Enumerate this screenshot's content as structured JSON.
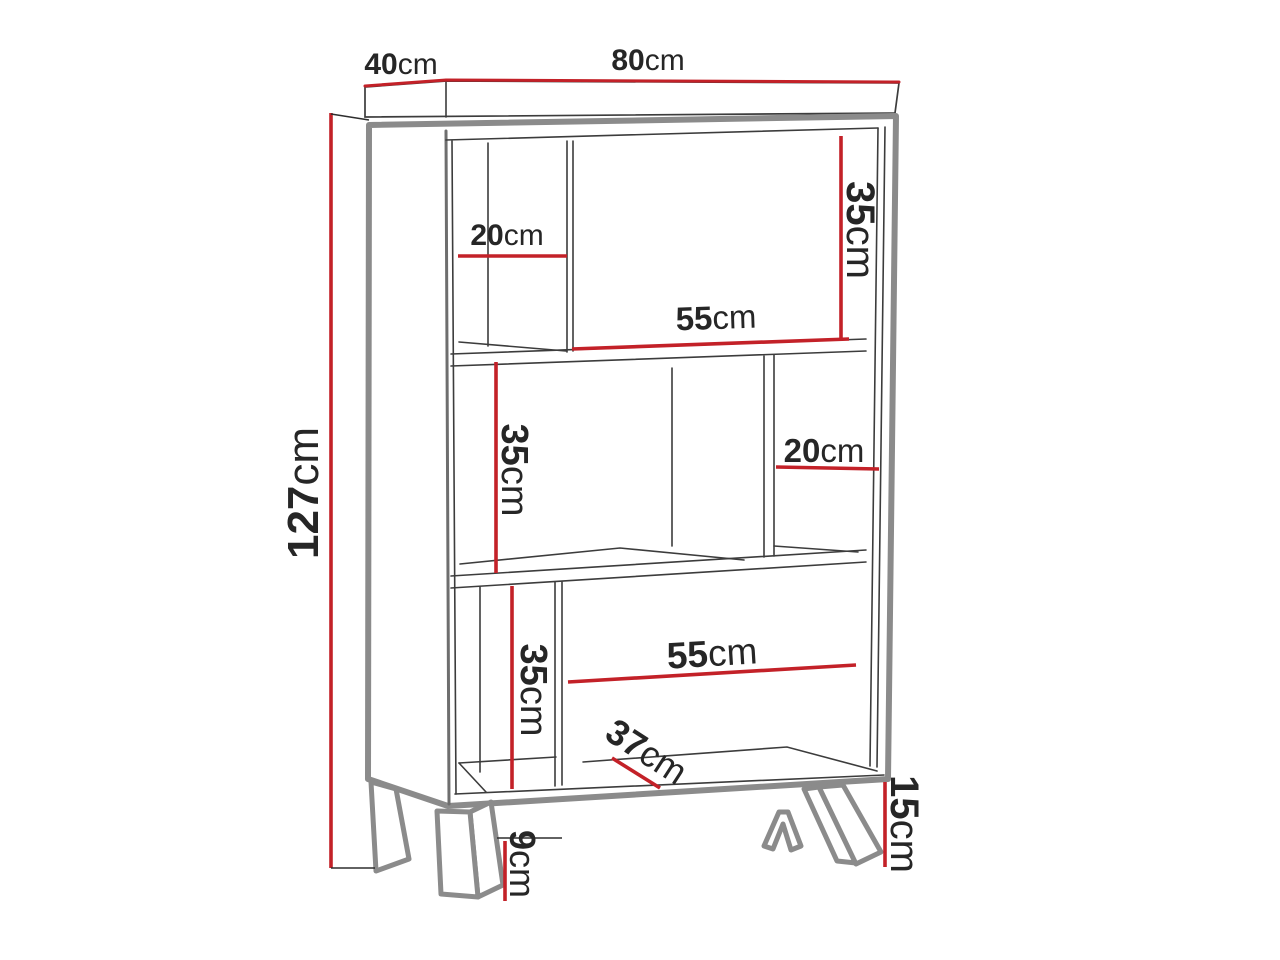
{
  "diagram": {
    "subject": "bookcase-dimension-drawing",
    "unit_system": "metric"
  },
  "colors": {
    "dimension_red": "#c32128",
    "outline_gray": "#8b8b8b",
    "line_dark": "#3c3c3c",
    "text": "#262626",
    "background": "#ffffff"
  },
  "labels": {
    "top_depth": {
      "value": "40",
      "unit": "cm"
    },
    "top_width": {
      "value": "80",
      "unit": "cm"
    },
    "total_height": {
      "value": "127",
      "unit": "cm"
    },
    "top_left_compartment_width": {
      "value": "20",
      "unit": "cm"
    },
    "top_section_height": {
      "value": "35",
      "unit": "cm"
    },
    "top_shelf_width": {
      "value": "55",
      "unit": "cm"
    },
    "middle_section_height": {
      "value": "35",
      "unit": "cm"
    },
    "middle_right_compartment_width": {
      "value": "20",
      "unit": "cm"
    },
    "bottom_section_height": {
      "value": "35",
      "unit": "cm"
    },
    "bottom_shelf_width": {
      "value": "55",
      "unit": "cm"
    },
    "bottom_shelf_depth": {
      "value": "37",
      "unit": "cm"
    },
    "front_leg_height": {
      "value": "9",
      "unit": "cm"
    },
    "leg_plinth_height": {
      "value": "15",
      "unit": "cm"
    }
  }
}
